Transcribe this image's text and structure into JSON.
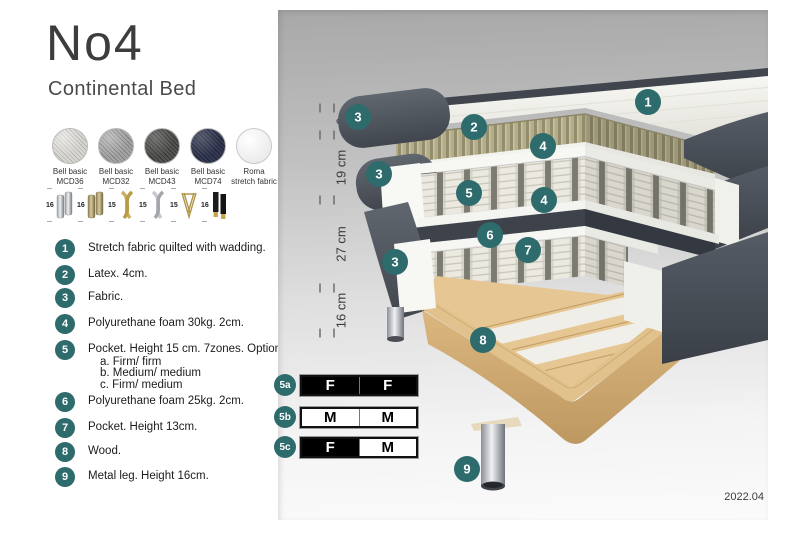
{
  "product": {
    "title": "No4",
    "subtitle": "Continental Bed"
  },
  "fabrics": [
    {
      "line1": "Bell basic",
      "line2": "MCD36"
    },
    {
      "line1": "Bell basic",
      "line2": "MCD32"
    },
    {
      "line1": "Bell basic",
      "line2": "MCD43"
    },
    {
      "line1": "Bell basic",
      "line2": "MCD74"
    },
    {
      "line1": "Roma",
      "line2": "stretch fabric"
    }
  ],
  "legs_options": [
    {
      "height": "16",
      "type": "cylinder-chrome"
    },
    {
      "height": "16",
      "type": "cylinder-brass"
    },
    {
      "height": "15",
      "type": "twisted-gold"
    },
    {
      "height": "15",
      "type": "twisted-silver"
    },
    {
      "height": "15",
      "type": "hairpin-brass"
    },
    {
      "height": "16",
      "type": "tapered-black-gold"
    }
  ],
  "parts": [
    {
      "num": "1",
      "text": "Stretch fabric quilted with wadding."
    },
    {
      "num": "2",
      "text": "Latex. 4cm."
    },
    {
      "num": "3",
      "text": "Fabric."
    },
    {
      "num": "4",
      "text": "Polyurethane foam 30kg. 2cm."
    },
    {
      "num": "5",
      "text": "Pocket. Height 15 cm. 7zones. Option:",
      "options": [
        "a. Firm/ firm",
        "b. Medium/ medium",
        "c. Firm/ medium"
      ]
    },
    {
      "num": "6",
      "text": "Polyurethane foam 25kg. 2cm."
    },
    {
      "num": "7",
      "text": "Pocket. Height 13cm."
    },
    {
      "num": "8",
      "text": "Wood."
    },
    {
      "num": "9",
      "text": "Metal leg. Height 16cm."
    }
  ],
  "diagram": {
    "dimensions": [
      {
        "label": "6"
      },
      {
        "label": "19 cm"
      },
      {
        "label": "27 cm"
      },
      {
        "label": "16 cm"
      }
    ],
    "callouts": [
      {
        "label": "1"
      },
      {
        "label": "3"
      },
      {
        "label": "2"
      },
      {
        "label": "4"
      },
      {
        "label": "3"
      },
      {
        "label": "5"
      },
      {
        "label": "4"
      },
      {
        "label": "6"
      },
      {
        "label": "7"
      },
      {
        "label": "3"
      },
      {
        "label": "8"
      },
      {
        "label": "9"
      }
    ]
  },
  "firmness_rows": [
    {
      "id": "5a",
      "cells": [
        {
          "label": "F",
          "cls": "cell dark"
        },
        {
          "label": "F",
          "cls": "cell dark"
        }
      ]
    },
    {
      "id": "5b",
      "cells": [
        {
          "label": "M",
          "cls": "cell light"
        },
        {
          "label": "M",
          "cls": "cell light"
        }
      ]
    },
    {
      "id": "5c",
      "cells": [
        {
          "label": "F",
          "cls": "cell dark"
        },
        {
          "label": "M",
          "cls": "cell light"
        }
      ]
    }
  ],
  "footer": {
    "version": "2022.04"
  },
  "colors": {
    "accent_teal": "#2e6b6c",
    "fabric_dark": "#51565e",
    "latex_band": "#b3ac8b",
    "spring_white": "#ebe8df",
    "wood": "#e3c795",
    "leg_chrome": "#c7cacd"
  }
}
